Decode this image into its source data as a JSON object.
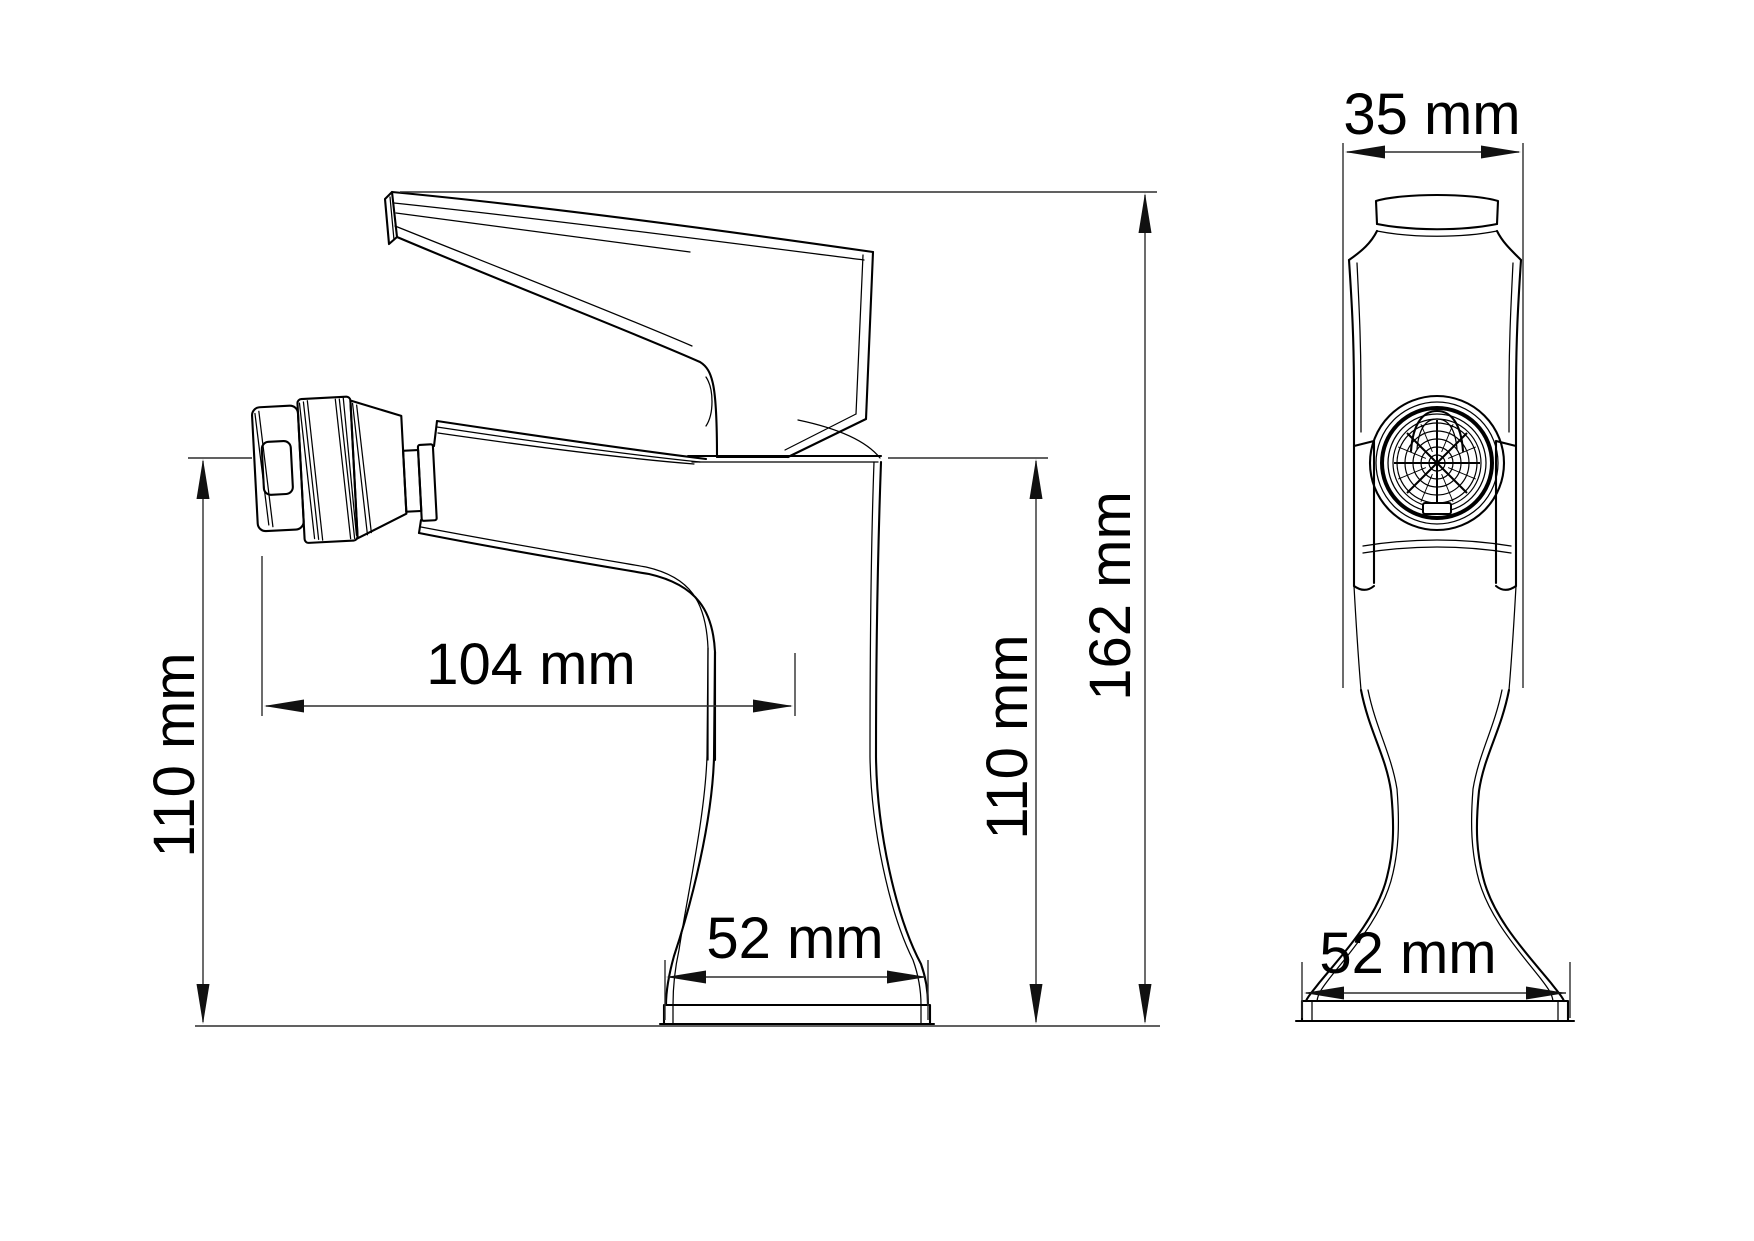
{
  "unit": "mm",
  "colors": {
    "background": "#ffffff",
    "outline": "#000000",
    "dimension": "#2d2d2d",
    "text": "#000000"
  },
  "views": {
    "side": {
      "name": "side view",
      "dimensions": {
        "height_left": {
          "label": "110 mm",
          "value": 110,
          "orientation": "vertical"
        },
        "spout_reach": {
          "label": "104 mm",
          "value": 104,
          "orientation": "horizontal"
        },
        "height_right": {
          "label": "110 mm",
          "value": 110,
          "orientation": "vertical"
        },
        "overall_height": {
          "label": "162 mm",
          "value": 162,
          "orientation": "vertical"
        },
        "base_width": {
          "label": "52 mm",
          "value": 52,
          "orientation": "horizontal"
        }
      }
    },
    "front": {
      "name": "front view",
      "dimensions": {
        "top_width": {
          "label": "35 mm",
          "value": 35,
          "orientation": "horizontal"
        },
        "base_width": {
          "label": "52 mm",
          "value": 52,
          "orientation": "horizontal"
        }
      }
    }
  }
}
